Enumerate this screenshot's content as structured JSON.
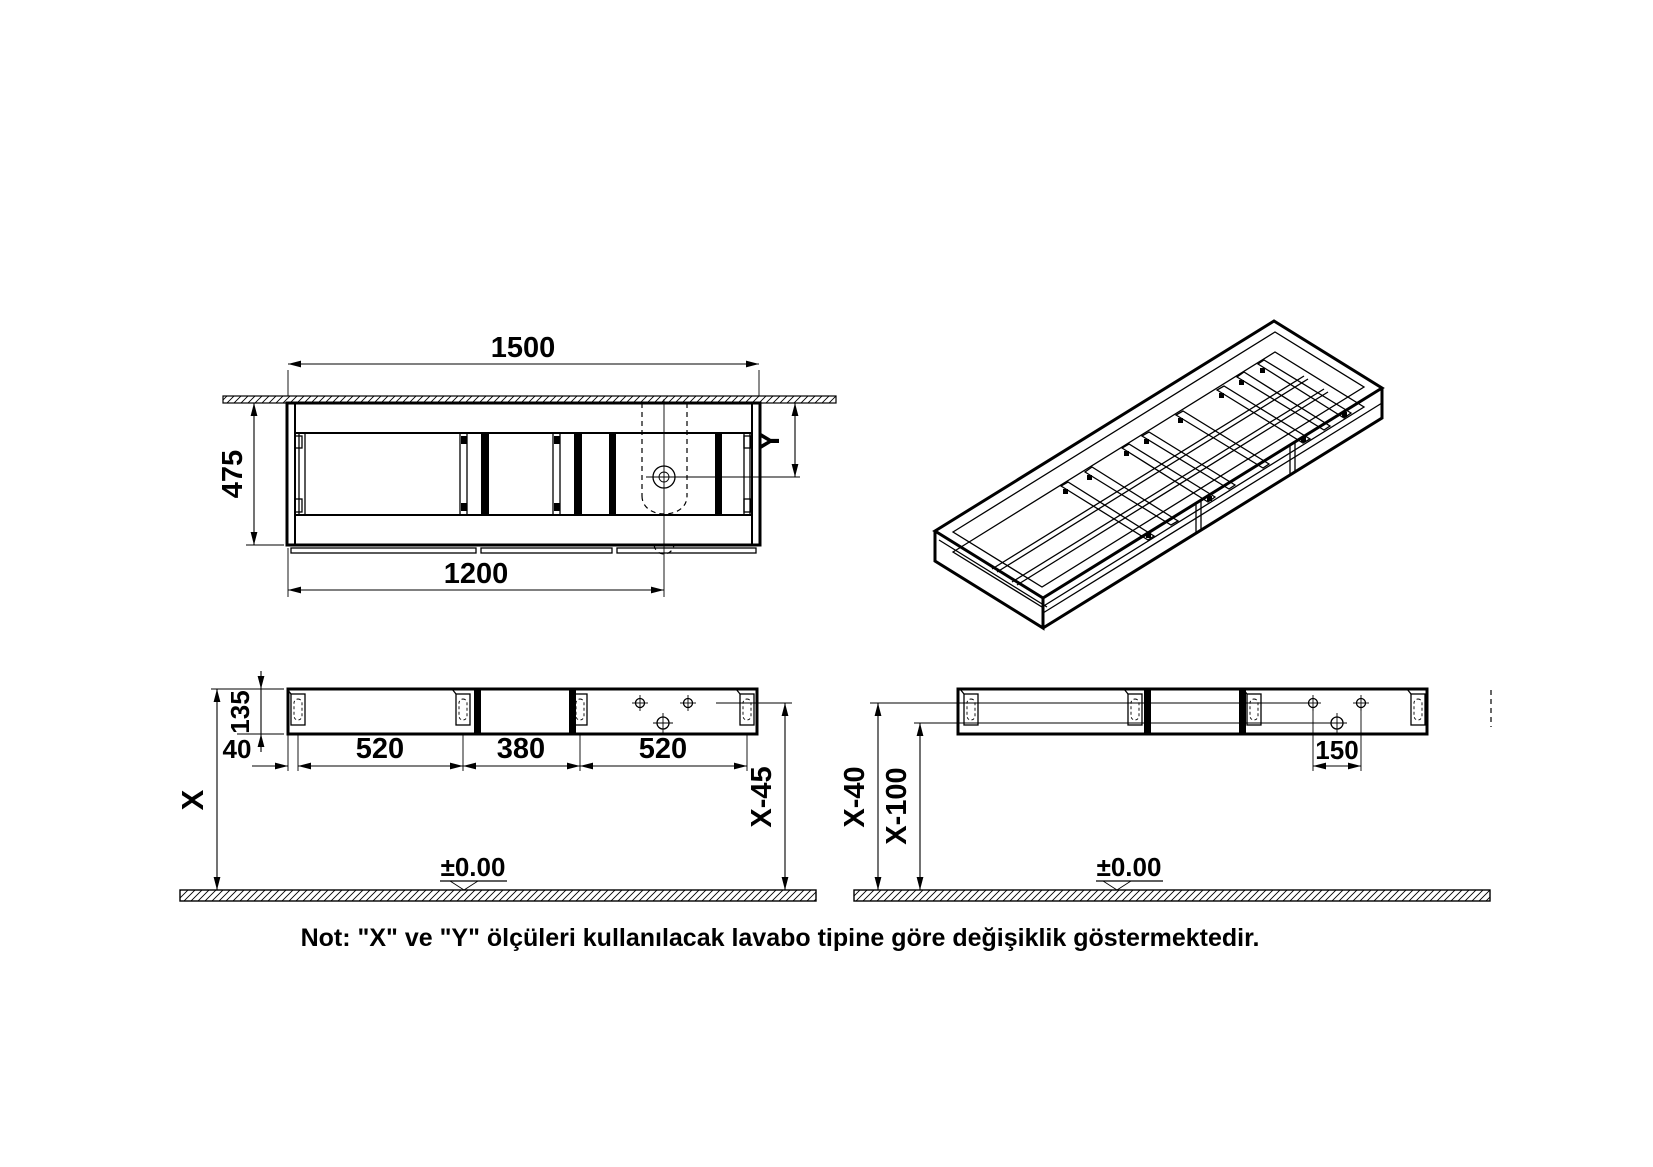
{
  "colors": {
    "ink": "#000000",
    "paper": "#ffffff"
  },
  "note": {
    "text": "Not: \"X\" ve \"Y\" ölçüleri kullanılacak lavabo tipine göre değişiklik göstermektedir."
  },
  "plan_view": {
    "name": "top view of cabinet under counter",
    "dim_width": "1500",
    "dim_depth": "475",
    "dim_drain_x": "1200",
    "dim_drain_y": "Y"
  },
  "iso_view": {
    "name": "isometric view of cabinet frame"
  },
  "front_view_left": {
    "name": "front view with bracket spacing",
    "dim_rail_height": "135",
    "dim_edge_offset": "40",
    "dim_span1": "520",
    "dim_span2": "380",
    "dim_span3": "520",
    "dim_top_height": "X",
    "dim_bracket_height": "X-45",
    "datum": "±0.00"
  },
  "front_view_right": {
    "name": "front view with hole heights",
    "dim_upper_holes": "X-40",
    "dim_lower_hole": "X-100",
    "dim_hole_spacing": "150",
    "datum": "±0.00"
  }
}
